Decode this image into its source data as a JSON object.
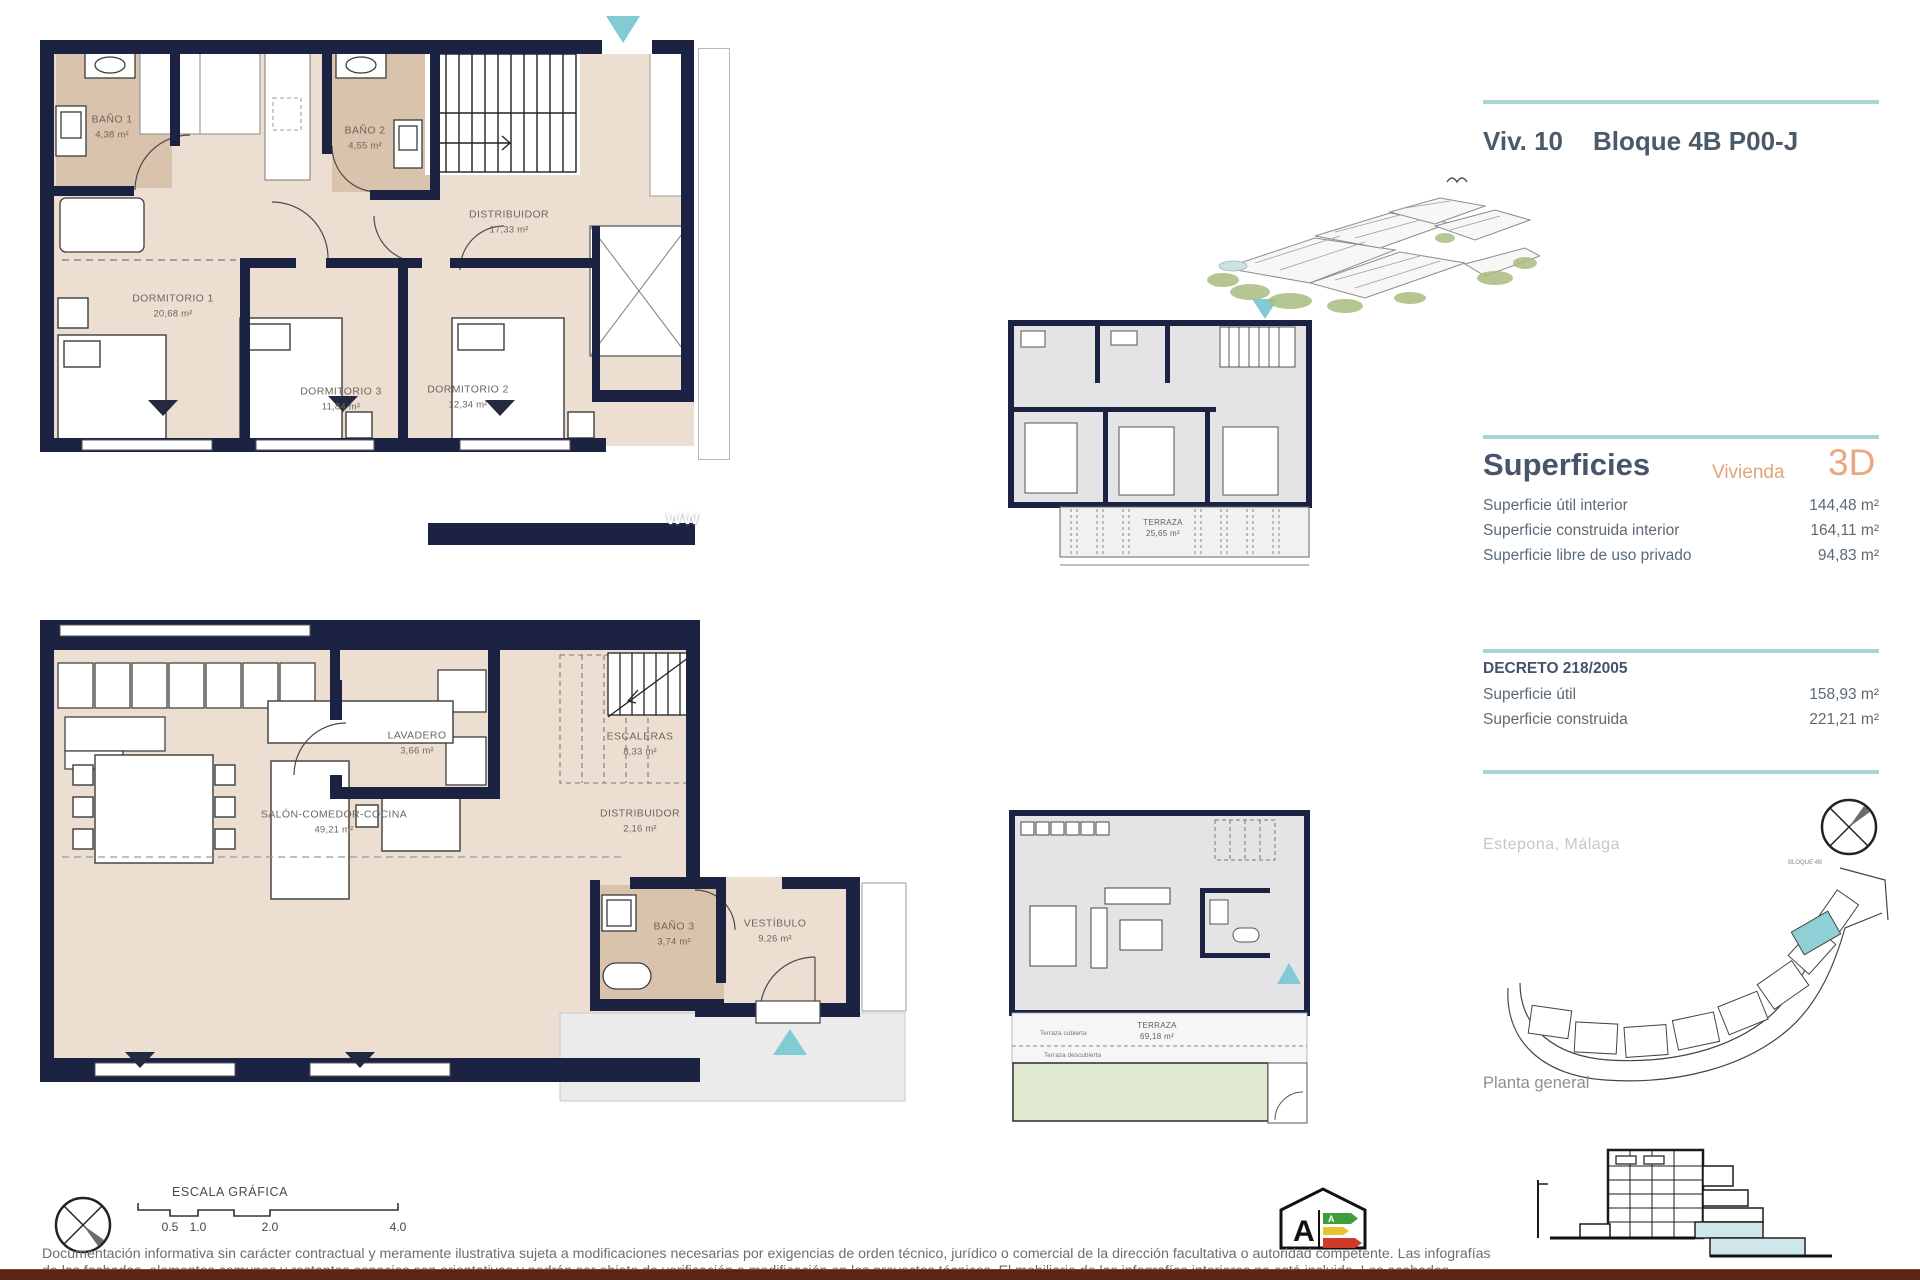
{
  "header": {
    "unit": "Viv. 10",
    "block": "Bloque 4B P00-J"
  },
  "superficies": {
    "title": "Superficies",
    "vivienda": "Vivienda",
    "tag3d": "3D",
    "rows": [
      {
        "label": "Superficie útil interior",
        "value": "144,48 m²"
      },
      {
        "label": "Superficie construida interior",
        "value": "164,11 m²"
      },
      {
        "label": "Superficie libre de uso privado",
        "value": "94,83 m²"
      }
    ]
  },
  "decreto": {
    "title": "DECRETO 218/2005",
    "rows": [
      {
        "label": "Superficie útil",
        "value": "158,93 m²"
      },
      {
        "label": "Superficie construida",
        "value": "221,21 m²"
      }
    ]
  },
  "location": "Estepona, Málaga",
  "planta_general": "Planta general",
  "site_label": "BLOQUE 4B",
  "watermark": "WW",
  "upper_plan": {
    "rooms": [
      {
        "name": "BAÑO 1",
        "area": "4,38 m²"
      },
      {
        "name": "BAÑO 2",
        "area": "4,55 m²"
      },
      {
        "name": "DISTRIBUIDOR",
        "area": "17,33 m²"
      },
      {
        "name": "DORMITORIO 1",
        "area": "20,68 m²"
      },
      {
        "name": "DORMITORIO 3",
        "area": "11,84 m²"
      },
      {
        "name": "DORMITORIO 2",
        "area": "12,34 m²"
      }
    ]
  },
  "lower_plan": {
    "rooms": [
      {
        "name": "LAVADERO",
        "area": "3,66 m²"
      },
      {
        "name": "ESCALERAS",
        "area": "8,33 m²"
      },
      {
        "name": "SALÓN-COMEDOR-COCINA",
        "area": "49,21 m²"
      },
      {
        "name": "DISTRIBUIDOR",
        "area": "2,16 m²"
      },
      {
        "name": "BAÑO 3",
        "area": "3,74 m²"
      },
      {
        "name": "VESTÍBULO",
        "area": "9,26 m²"
      }
    ]
  },
  "mini_upper": {
    "name": "TERRAZA",
    "area": "25,65 m²"
  },
  "mini_lower": {
    "name": "TERRAZA",
    "area": "69,18 m²",
    "covered": "Terraza cubierta",
    "uncovered": "Terraza descubierta"
  },
  "scale_bar": {
    "title": "ESCALA GRÁFICA",
    "ticks": [
      "0.5",
      "1.0",
      "2.0",
      "4.0"
    ]
  },
  "energy": {
    "a_left": "A",
    "a_right": "A"
  },
  "disclaimer": {
    "line1": "Documentación informativa sin carácter contractual y meramente ilustrativa sujeta a modificaciones necesarias por exigencias de orden técnico, jurídico o comercial de la dirección facultativa o autoridad competente. Las infografías",
    "line2": "de las fachadas, elementos comunes y restantes espacios son orientativas y podrán ser objeto de verificación o modificación en los proyectos técnicos. El mobiliario de las infografías interiores no está incluido. Los acabados"
  },
  "colors": {
    "wall_navy": "#1c2342",
    "room_beige": "#ecdfd2",
    "bath_tan": "#d9c3ad",
    "accent_teal": "#82cbd4",
    "line_teal": "#a8d6d4",
    "orange": "#e2a37c",
    "slate": "#4b5a68",
    "footer_brown": "#5a2514"
  }
}
